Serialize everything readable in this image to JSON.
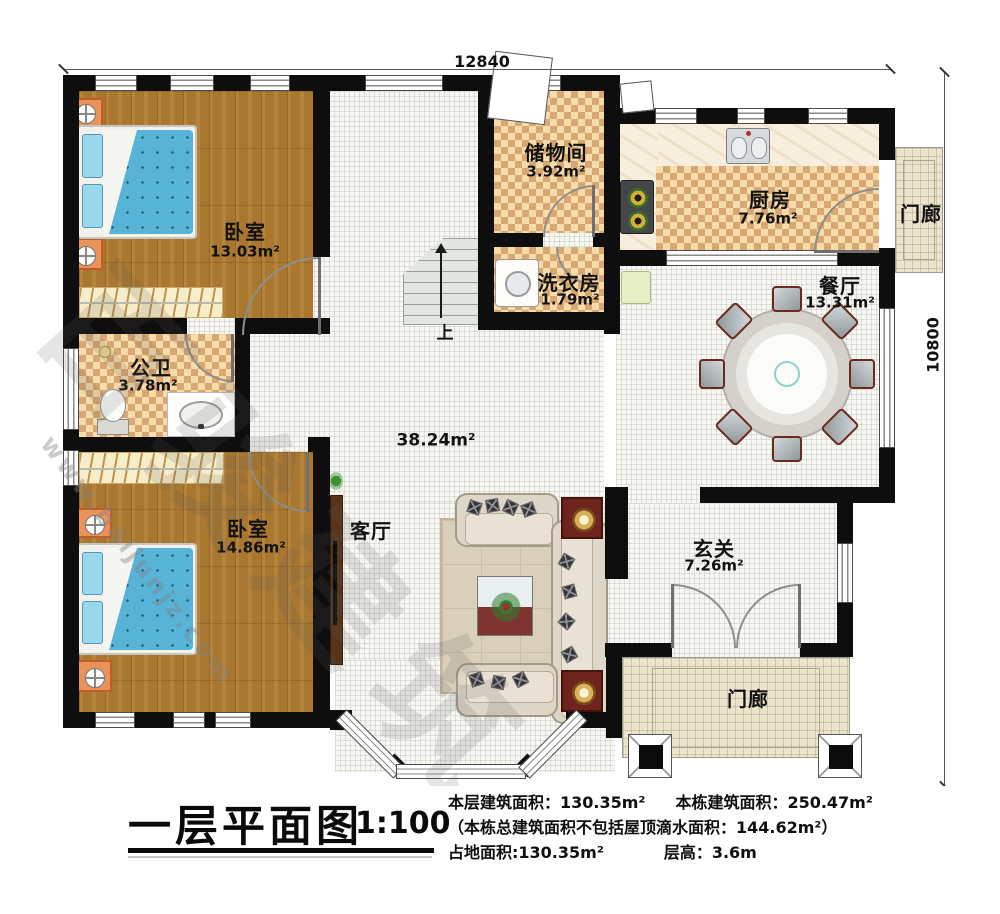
{
  "dimensions": {
    "top": "12840",
    "right": "10800"
  },
  "rooms": {
    "bedroom1": {
      "name": "卧室",
      "area": "13.03m²"
    },
    "storage": {
      "name": "储物间",
      "area": "3.92m²"
    },
    "kitchen": {
      "name": "厨房",
      "area": "7.76m²"
    },
    "porch_right": {
      "name": "门廊"
    },
    "dining": {
      "name": "餐厅",
      "area": "13.31m²"
    },
    "laundry": {
      "name": "洗衣房",
      "area": "1.79m²"
    },
    "bathroom": {
      "name": "公卫",
      "area": "3.78m²"
    },
    "bedroom2": {
      "name": "卧室",
      "area": "14.86m²"
    },
    "living": {
      "name": "客厅"
    },
    "open_area": {
      "area": "38.24m²"
    },
    "foyer": {
      "name": "玄关",
      "area": "7.26m²"
    },
    "porch_bottom": {
      "name": "门廊"
    }
  },
  "stairs": {
    "direction_label": "上"
  },
  "title_block": {
    "title": "一层平面图",
    "scale": "1:100",
    "floor_area": "本层建筑面积：130.35m²",
    "building_area": "本栋建筑面积：250.47m²",
    "note": "（本栋总建筑面积不包括屋顶滴水面积：144.62m²）",
    "footprint": "占地面积:130.35m²",
    "storey_height": "层高：3.6m"
  },
  "watermark": {
    "site": "www.baijunjz.com",
    "brand": "百骏建筑"
  },
  "colors": {
    "wall": "#0e0e0e",
    "wood_floor": "#a9772f",
    "checker_light": "#f6dcab",
    "checker_dark": "#d9a771",
    "tile_floor": "#f7f7f4",
    "porch_floor": "#ece4cd",
    "bed_blue": "#57b4d7",
    "accent_red": "#7e3430",
    "nightstand_orange": "#ea9258"
  }
}
